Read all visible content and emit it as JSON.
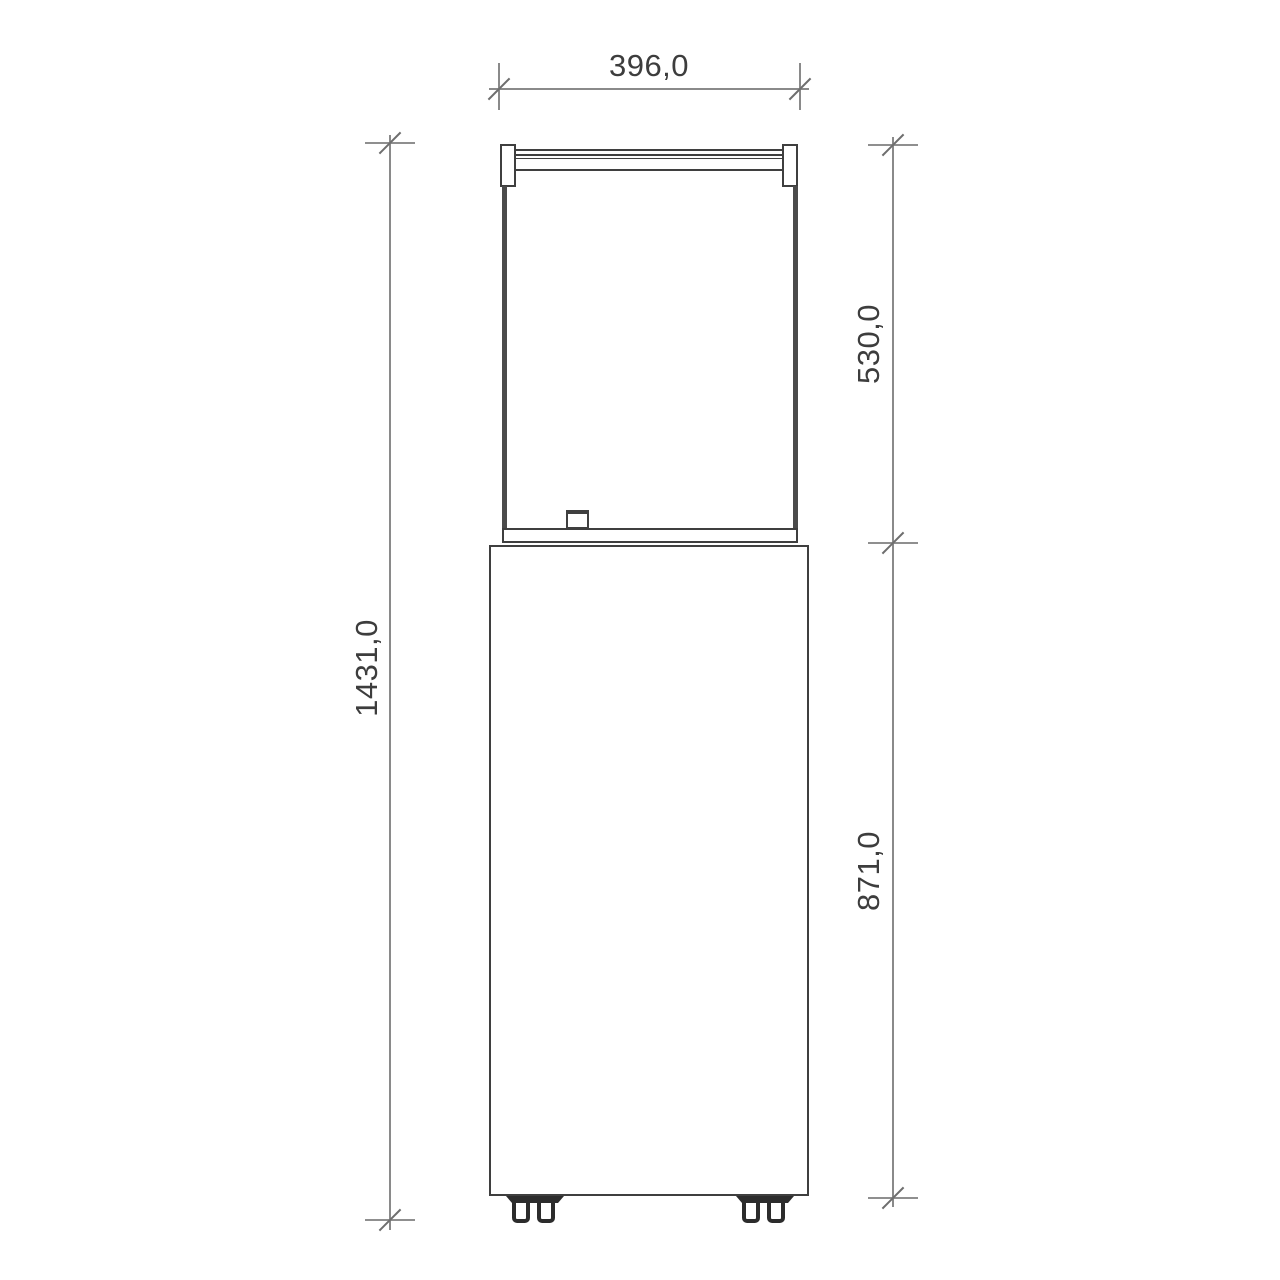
{
  "drawing": {
    "type": "technical-dimension-drawing",
    "view": "front-elevation",
    "dimension_labels": {
      "width_top": "396,0",
      "glass_section_height": "530,0",
      "base_section_height": "871,0",
      "total_height": "1431,0"
    },
    "colors": {
      "background": "#ffffff",
      "object_outline": "#3f3f3f",
      "glass_edge": "#4b4b4b",
      "dimension_line": "#8a8a8a",
      "tick_mark": "#6e6e6e",
      "label_text": "#3d3d3d"
    }
  }
}
